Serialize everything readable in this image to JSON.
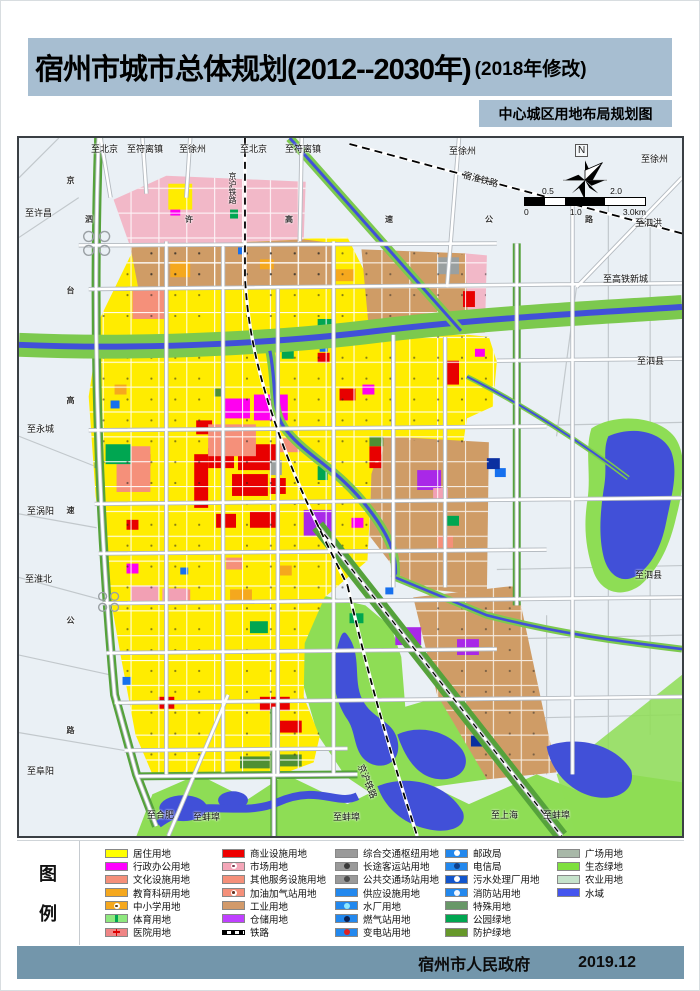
{
  "page": {
    "title_main": "宿州市城市总体规划(2012--2030年)",
    "title_suffix": "(2018年修改)",
    "subtitle": "中心城区用地布局规划图",
    "footer_org": "宿州市人民政府",
    "footer_date": "2019.12"
  },
  "legend": {
    "box_char_1": "图",
    "box_char_2": "例",
    "columns": [
      {
        "items": [
          {
            "label": "居住用地",
            "color": "#ffff00"
          },
          {
            "label": "行政办公用地",
            "color": "#ff00ff"
          },
          {
            "label": "文化设施用地",
            "color": "#f5907a"
          },
          {
            "label": "教育科研用地",
            "color": "#f5a81e"
          },
          {
            "label": "中小学用地",
            "color": "#f5a81e",
            "sym": "#5a3c14"
          },
          {
            "label": "体育用地",
            "color": "#8ee87e"
          },
          {
            "label": "医院用地",
            "color": "#ef8585"
          }
        ]
      },
      {
        "items": [
          {
            "label": "商业设施用地",
            "color": "#ee0000"
          },
          {
            "label": "市场用地",
            "color": "#f4a6b8",
            "sym": "#7a3c50"
          },
          {
            "label": "其他服务设施用地",
            "color": "#f5907a"
          },
          {
            "label": "加油加气站用地",
            "color": "#f5907a",
            "sym": "#6e3420"
          },
          {
            "label": "工业用地",
            "color": "#d29a6a"
          },
          {
            "label": "仓储用地",
            "color": "#bf40ff"
          },
          {
            "label": "铁路",
            "color": "#000000"
          }
        ]
      },
      {
        "items": [
          {
            "label": "综合交通枢纽用地",
            "color": "#9a9a9a"
          },
          {
            "label": "长途客运站用地",
            "color": "#9a9a9a",
            "sym": "#3a3a3a"
          },
          {
            "label": "公共交通场站用地",
            "color": "#9a9a9a",
            "sym": "#4a4a4a"
          },
          {
            "label": "供应设施用地",
            "color": "#2288ee"
          },
          {
            "label": "水厂用地",
            "color": "#2288ee",
            "sym": "#8fe8ff"
          },
          {
            "label": "燃气站用地",
            "color": "#2288ee",
            "sym": "#0b2050"
          },
          {
            "label": "变电站用地",
            "color": "#2288ee",
            "sym": "#e02020"
          }
        ]
      },
      {
        "items": [
          {
            "label": "邮政局",
            "color": "#2288ee",
            "sym": "#ffffff"
          },
          {
            "label": "电信局",
            "color": "#2288ee",
            "sym": "#10408a"
          },
          {
            "label": "污水处理厂用地",
            "color": "#1155cc",
            "sym": "#ffffff"
          },
          {
            "label": "消防站用地",
            "color": "#2288ee",
            "sym": "#f0f6ff"
          },
          {
            "label": "特殊用地",
            "color": "#689868"
          },
          {
            "label": "公园绿地",
            "color": "#00a651"
          },
          {
            "label": "防护绿地",
            "color": "#66982a"
          }
        ]
      },
      {
        "items": [
          {
            "label": "广场用地",
            "color": "#a8b8a8"
          },
          {
            "label": "生态绿地",
            "color": "#7fe03e"
          },
          {
            "label": "农业用地",
            "color": "#c6e3cb"
          },
          {
            "label": "水域",
            "color": "#4455ee"
          }
        ]
      }
    ]
  },
  "map": {
    "north_label": "N",
    "scale": {
      "top_left": "0.5",
      "top_right": "2.0",
      "b0": "0",
      "b1": "1.0",
      "b2": "3.0km"
    },
    "labels": [
      {
        "text": "至北京"
      },
      {
        "text": "至符离镇"
      },
      {
        "text": "至徐州"
      },
      {
        "text": "至北京"
      },
      {
        "text": "至符离镇"
      },
      {
        "text": "至徐州"
      },
      {
        "text": "至徐州"
      },
      {
        "text": "至许昌"
      },
      {
        "text": "至永城"
      },
      {
        "text": "至涡阳"
      },
      {
        "text": "至淮北"
      },
      {
        "text": "至阜阳"
      },
      {
        "text": "至泗洪"
      },
      {
        "text": "至高铁新城"
      },
      {
        "text": "至泗县"
      },
      {
        "text": "至泗县"
      },
      {
        "text": "至合肥"
      },
      {
        "text": "至蚌埠"
      },
      {
        "text": "至蚌埠"
      },
      {
        "text": "至上海"
      },
      {
        "text": "至蚌埠"
      },
      {
        "text": "宿淮铁路"
      },
      {
        "text": "京沪铁路"
      },
      {
        "text": "京沪铁路"
      },
      {
        "text": "泗许高速公路"
      },
      {
        "text": "京台高速公路"
      }
    ],
    "palette": {
      "residential": "#ffec00",
      "commercial": "#e80000",
      "admin": "#ff00f0",
      "industrial": "#cf9c66",
      "warehouse": "#a928e8",
      "park_green": "#00a651",
      "eco_green": "#8edd55",
      "buffer_green": "#55a23b",
      "water": "#4150d8",
      "town_pink": "#f2b8c8",
      "background": "#eaf0f5"
    }
  }
}
